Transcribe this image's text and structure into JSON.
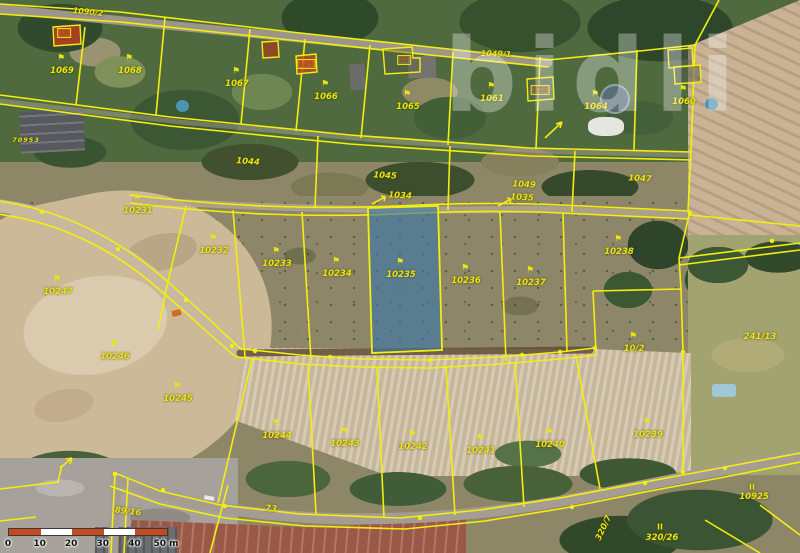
{
  "map": {
    "watermark": "bidli",
    "selected_parcel": "10235",
    "icon_glyph": "⚑",
    "colors": {
      "line": "#f4ee10",
      "selection_fill": "rgba(58,118,170,0.62)",
      "selection_border": "#f4ee10"
    },
    "labels": [
      {
        "t": "1090/2",
        "x": 88,
        "y": 12,
        "r": 6,
        "k": "road"
      },
      {
        "t": "1049/1",
        "x": 496,
        "y": 54,
        "r": 2,
        "k": "road"
      },
      {
        "t": "1069",
        "x": 62,
        "y": 71,
        "i": 1
      },
      {
        "t": "1068",
        "x": 130,
        "y": 71,
        "i": 1
      },
      {
        "t": "1067",
        "x": 237,
        "y": 84,
        "i": 1
      },
      {
        "t": "1066",
        "x": 326,
        "y": 97,
        "i": 1
      },
      {
        "t": "1065",
        "x": 408,
        "y": 107,
        "i": 1
      },
      {
        "t": "1061",
        "x": 492,
        "y": 99,
        "i": 1
      },
      {
        "t": "1064",
        "x": 596,
        "y": 107,
        "i": 1
      },
      {
        "t": "1060",
        "x": 684,
        "y": 102,
        "i": 1
      },
      {
        "t": "16",
        "x": 64,
        "y": 33,
        "k": "bnum"
      },
      {
        "t": "125",
        "x": 306,
        "y": 64,
        "k": "bnum"
      },
      {
        "t": "22",
        "x": 404,
        "y": 60,
        "k": "bnum"
      },
      {
        "t": "172",
        "x": 540,
        "y": 90,
        "k": "bnum"
      },
      {
        "t": "70953",
        "x": 26,
        "y": 140,
        "k": "tiny"
      },
      {
        "t": "1044",
        "x": 248,
        "y": 162,
        "r": 4,
        "k": "plain"
      },
      {
        "t": "1045",
        "x": 385,
        "y": 176,
        "r": 3,
        "k": "plain"
      },
      {
        "t": "1049",
        "x": 524,
        "y": 185,
        "r": 3,
        "k": "plain"
      },
      {
        "t": "1047",
        "x": 640,
        "y": 179,
        "r": 3,
        "k": "plain"
      },
      {
        "t": "1034",
        "x": 400,
        "y": 196,
        "r": 3,
        "k": "plain"
      },
      {
        "t": "1035",
        "x": 522,
        "y": 198,
        "r": 3,
        "k": "plain"
      },
      {
        "t": "10231",
        "x": 138,
        "y": 211,
        "i": 1
      },
      {
        "t": "10232",
        "x": 214,
        "y": 251,
        "i": 1
      },
      {
        "t": "10233",
        "x": 277,
        "y": 264,
        "i": 1
      },
      {
        "t": "10234",
        "x": 337,
        "y": 274,
        "i": 1
      },
      {
        "t": "10235",
        "x": 401,
        "y": 275,
        "i": 1
      },
      {
        "t": "10236",
        "x": 466,
        "y": 281,
        "i": 1
      },
      {
        "t": "10237",
        "x": 531,
        "y": 283,
        "i": 1
      },
      {
        "t": "10238",
        "x": 619,
        "y": 252,
        "i": 1
      },
      {
        "t": "10/2",
        "x": 634,
        "y": 349,
        "i": 1
      },
      {
        "t": "241/13",
        "x": 760,
        "y": 337,
        "k": "plain"
      },
      {
        "t": "10247",
        "x": 58,
        "y": 292,
        "i": 1
      },
      {
        "t": "10246",
        "x": 115,
        "y": 357,
        "i": 1
      },
      {
        "t": "10245",
        "x": 178,
        "y": 399,
        "i": 1
      },
      {
        "t": "10244",
        "x": 277,
        "y": 436,
        "i": 1
      },
      {
        "t": "10243",
        "x": 345,
        "y": 444,
        "i": 1
      },
      {
        "t": "10242",
        "x": 413,
        "y": 447,
        "i": 1
      },
      {
        "t": "10241",
        "x": 481,
        "y": 451,
        "i": 1
      },
      {
        "t": "10240",
        "x": 550,
        "y": 445,
        "i": 1
      },
      {
        "t": "10239",
        "x": 648,
        "y": 435,
        "i": 1
      },
      {
        "t": "89/16",
        "x": 128,
        "y": 512,
        "r": 7,
        "k": "plain"
      },
      {
        "t": "73",
        "x": 271,
        "y": 509,
        "r": 5,
        "k": "plain"
      },
      {
        "t": "II",
        "x": 752,
        "y": 487,
        "k": "mark"
      },
      {
        "t": "10925",
        "x": 754,
        "y": 497,
        "k": "plain"
      },
      {
        "t": "II",
        "x": 660,
        "y": 527,
        "k": "mark"
      },
      {
        "t": "320/26",
        "x": 662,
        "y": 538,
        "k": "plain"
      },
      {
        "t": "320/7",
        "x": 604,
        "y": 528,
        "r": -65,
        "k": "plain"
      }
    ],
    "scale_bar": {
      "ticks": [
        "0",
        "10",
        "20",
        "30",
        "40",
        "50 m"
      ],
      "segment_colors": [
        "#c44a20",
        "#ffffff",
        "#c44a20",
        "#ffffff",
        "#c44a20"
      ]
    }
  }
}
